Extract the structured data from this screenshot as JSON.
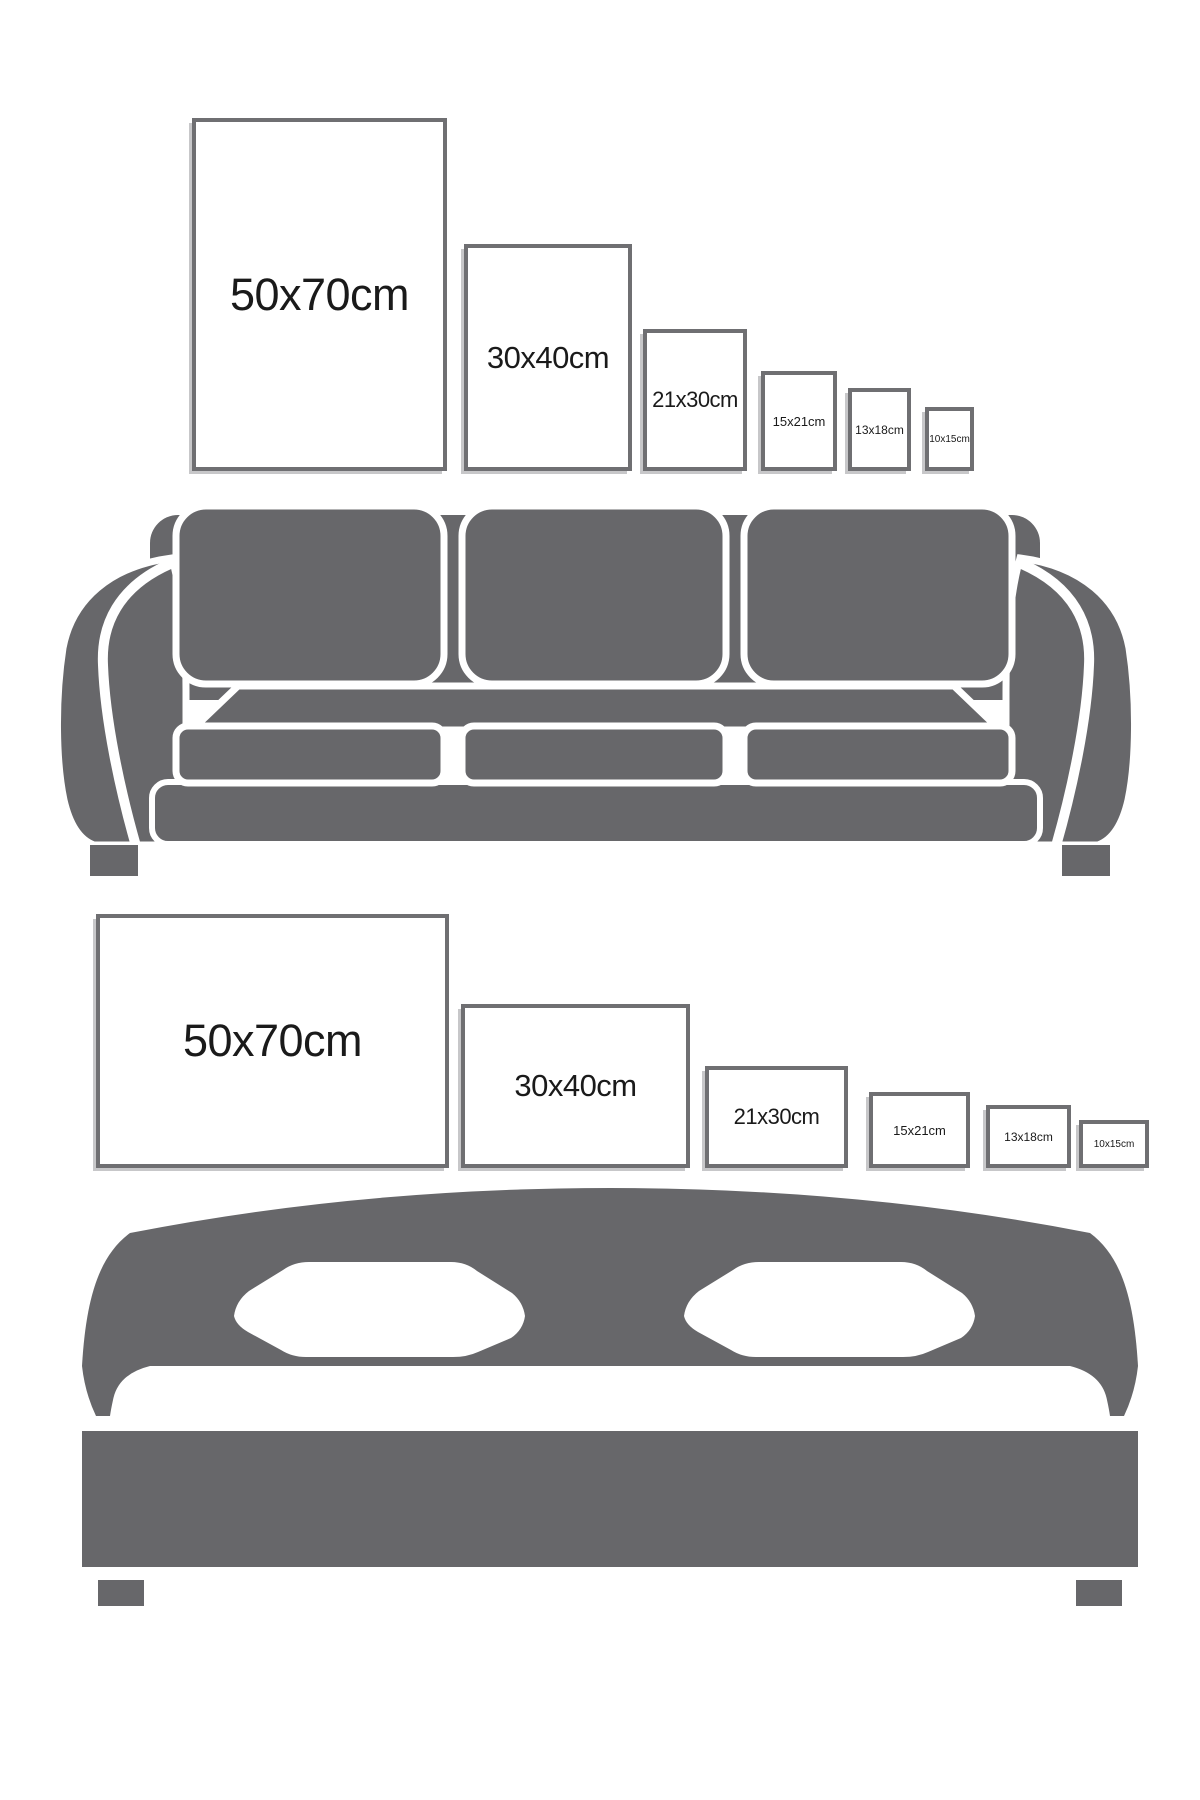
{
  "colors": {
    "background": "#ffffff",
    "furniture_gray": "#67676a",
    "frame_border": "#6f6f72",
    "frame_shadow": "#c7c7c9",
    "label_text": "#1a1a1a"
  },
  "size_guide": {
    "sofa_section": {
      "furniture": "sofa",
      "orientation": "portrait",
      "frames": [
        {
          "label": "50x70cm"
        },
        {
          "label": "30x40cm"
        },
        {
          "label": "21x30cm"
        },
        {
          "label": "15x21cm"
        },
        {
          "label": "13x18cm"
        },
        {
          "label": "10x15cm"
        }
      ]
    },
    "bed_section": {
      "furniture": "bed",
      "orientation": "landscape",
      "frames": [
        {
          "label": "50x70cm"
        },
        {
          "label": "30x40cm"
        },
        {
          "label": "21x30cm"
        },
        {
          "label": "15x21cm"
        },
        {
          "label": "13x18cm"
        },
        {
          "label": "10x15cm"
        }
      ]
    }
  }
}
